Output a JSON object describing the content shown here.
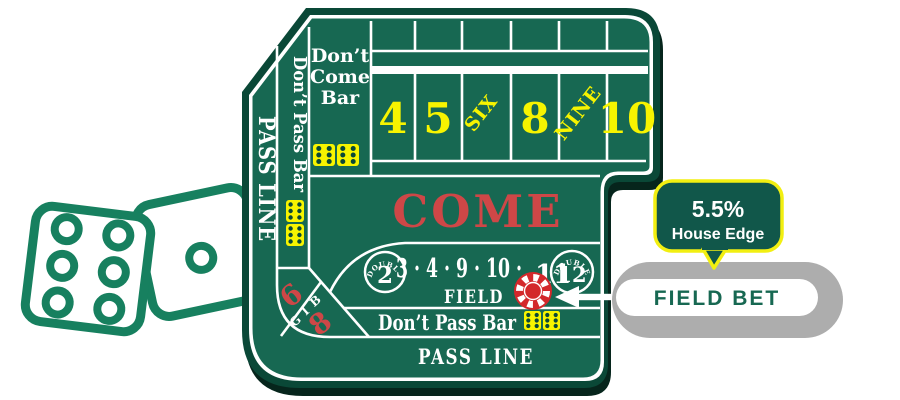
{
  "table": {
    "dont_come": [
      "Don’t",
      "Come",
      "Bar"
    ],
    "point_boxes": [
      "4",
      "5",
      "SIX",
      "8",
      "NINE",
      "10"
    ],
    "come_label": "COME",
    "pass_line_side": "PASS LINE",
    "dont_pass_bar_side": "Don’t Pass Bar",
    "big_six": "6",
    "big_letters": [
      "B",
      "I",
      "G"
    ],
    "big_eight": "8",
    "field": {
      "double_label": "DOUBLE",
      "double_left_number": "2",
      "numbers": "3 · 4 · 9 · 10 ·",
      "last_number": "11",
      "double_right_number": "12",
      "field_label": "FIELD"
    },
    "dont_pass_bar_bottom": "Don’t Pass Bar",
    "pass_line_bottom": "PASS LINE"
  },
  "callout": {
    "percent": "5.5%",
    "caption": "House Edge"
  },
  "pill": {
    "label": "FIELD BET"
  },
  "colors": {
    "felt": "#176852",
    "border": "#0a4837",
    "shadow": "#06251c",
    "line_white": "#ffffff",
    "yellow": "#f7f400",
    "red": "#ce4747",
    "chip_red": "#d3282b",
    "dice_outline_green": "#17805f",
    "callout_fill": "#11574a",
    "callout_border": "#f2ef11",
    "pill_gray": "#adadad",
    "pill_text_green": "#176852"
  }
}
